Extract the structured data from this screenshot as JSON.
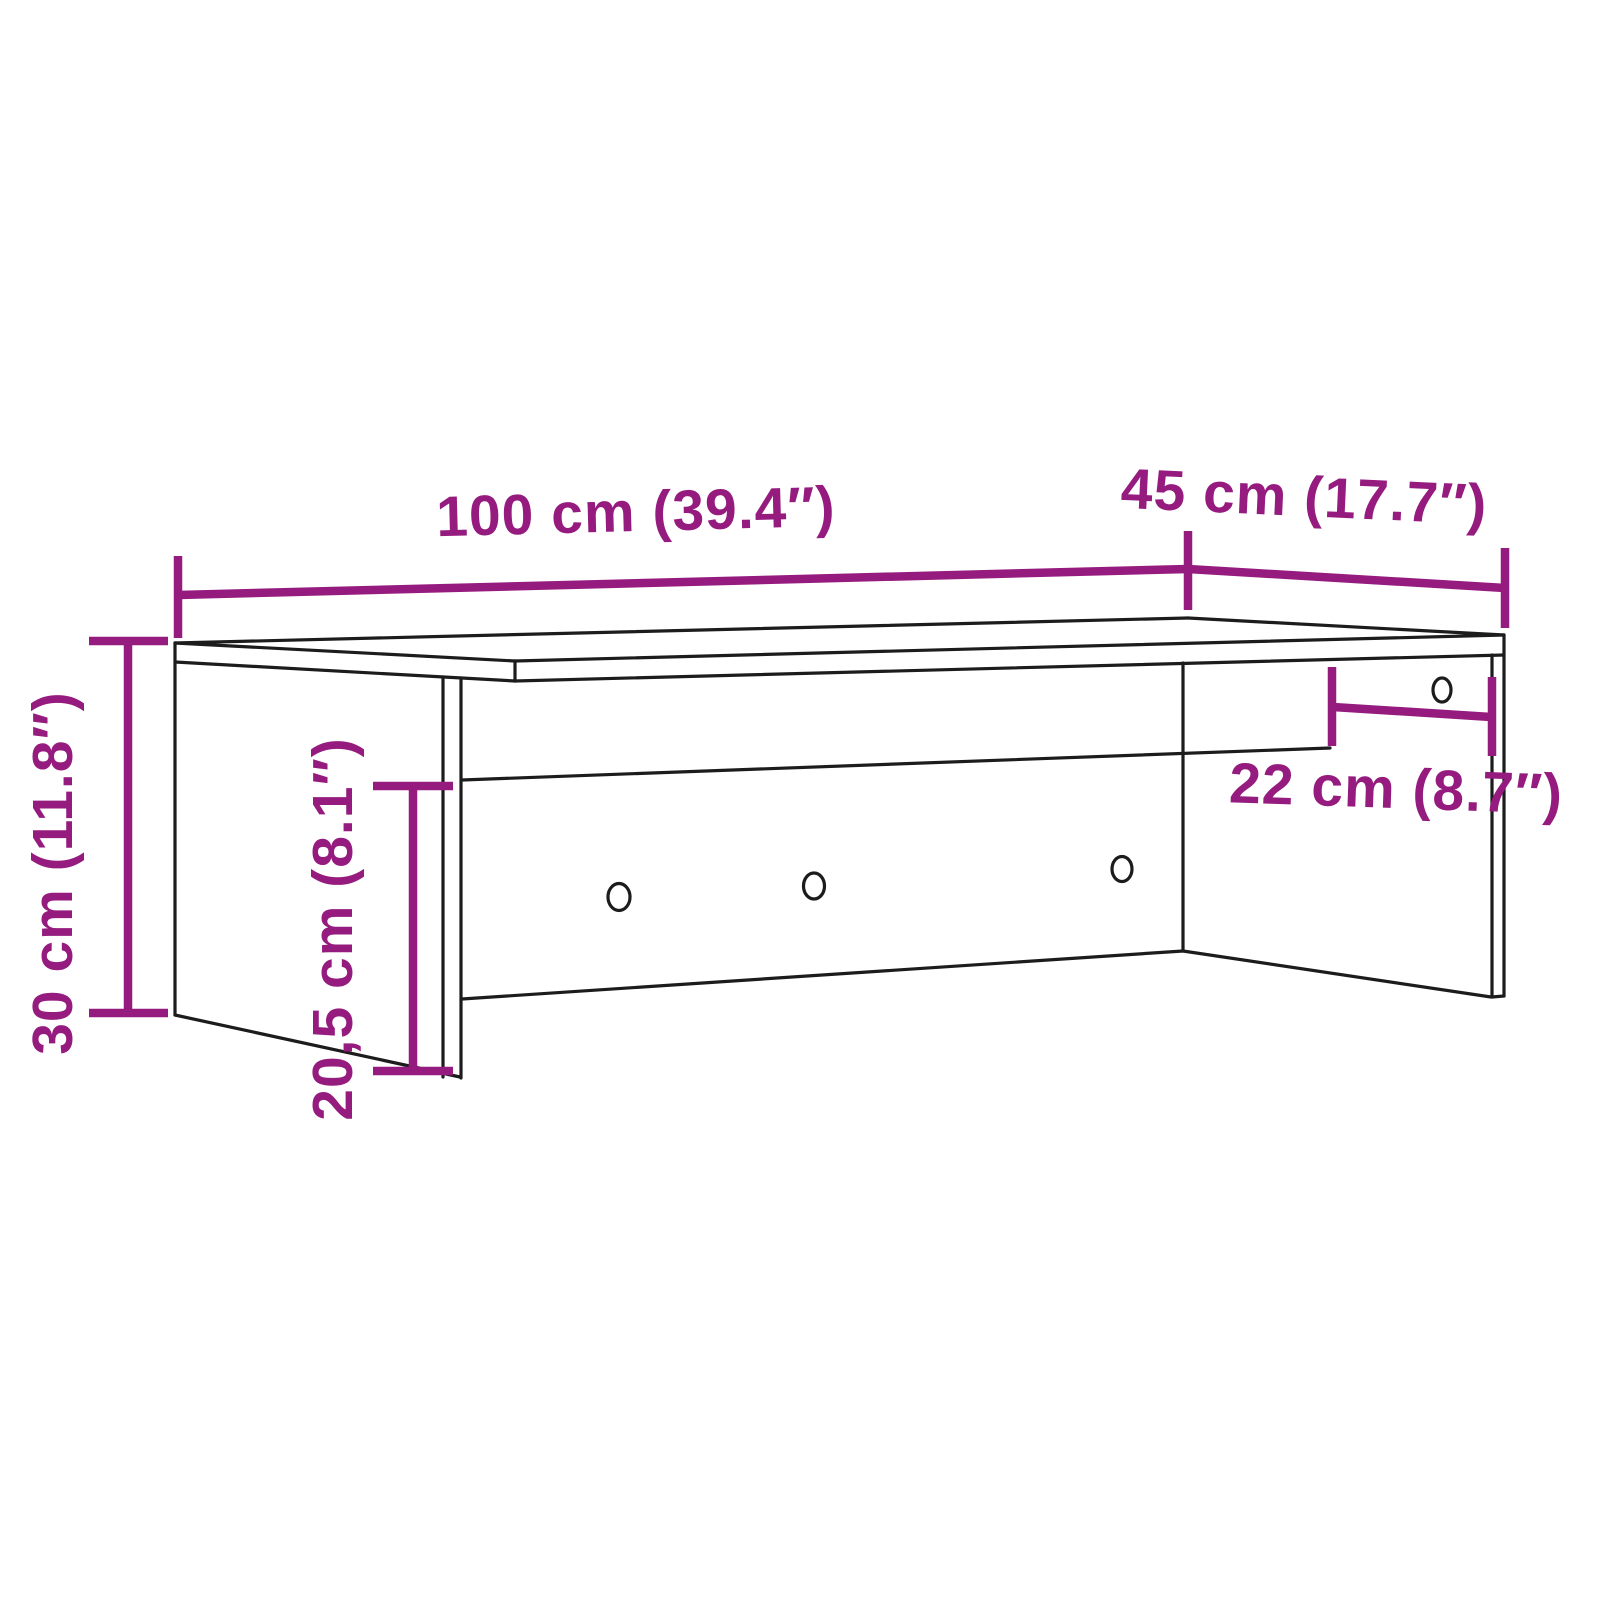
{
  "diagram": {
    "kind": "furniture-dimension-diagram",
    "dimensions": {
      "width": {
        "label": "100 cm (39.4″)"
      },
      "depth": {
        "label": "45 cm (17.7″)"
      },
      "height": {
        "label": "30 cm (11.8″)"
      },
      "opening_height": {
        "label": "20,5 cm (8.1″)"
      },
      "right_opening": {
        "label": "22 cm (8.7″)"
      }
    },
    "colors": {
      "dimension": "#951B7F",
      "outline": "#1C1C1C",
      "background": "#FFFFFF"
    },
    "holes": {
      "count": "4"
    }
  }
}
